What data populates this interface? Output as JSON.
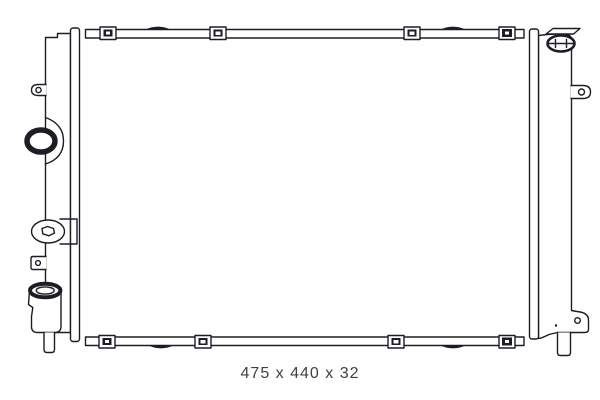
{
  "figure": {
    "type": "technical-line-drawing",
    "subject": "radiator",
    "caption": "475 x 440 x 32",
    "colors": {
      "background": "#ffffff",
      "line": "#1d1d24",
      "caption_text": "#414141"
    }
  }
}
